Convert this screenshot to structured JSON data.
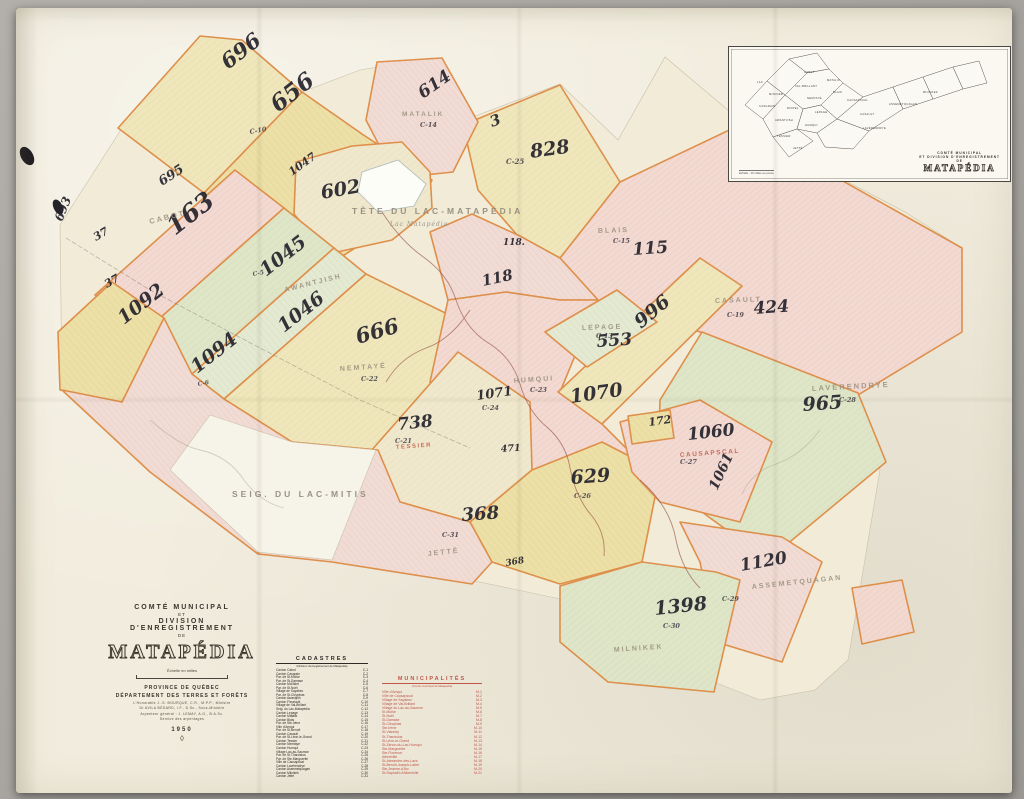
{
  "title_block": {
    "line1": "COMTÉ MUNICIPAL",
    "line2": "ET",
    "line3": "DIVISION D'ENREGISTREMENT",
    "line4": "DE",
    "name": "MATAPÉDIA",
    "scale_caption": "Échelle en milles",
    "province": "PROVINCE DE QUÉBEC",
    "department": "DÉPARTEMENT DES TERRES ET FORÊTS",
    "minister": "L'Honorable J.-S. BOURQUE, C.R., M.P.P., Ministre",
    "deputy": "Dr AVILA BÉDARD, I.F., D.Sc., Sous-Ministre",
    "surveyor": "Arpenteur général : J. LEMAY, A.G., B.A.Sc.",
    "service": "Service des arpentages",
    "year": "1950",
    "ornament": "◊"
  },
  "cadastres": {
    "title": "CADASTRES",
    "subtitle": "(Division d'enregistrement de Matapédia)",
    "rows": [
      {
        "n": "Canton Cabot",
        "c": "C-1"
      },
      {
        "n": "Canton Casgrain",
        "c": "C-2"
      },
      {
        "n": "Par. de St-Moïse",
        "c": "C-3"
      },
      {
        "n": "Par. de St-Damase",
        "c": "C-4"
      },
      {
        "n": "Canton McNider",
        "c": "C-5"
      },
      {
        "n": "Par. de St-Noël",
        "c": "C-6"
      },
      {
        "n": "Village de Sayabec",
        "c": "C-7"
      },
      {
        "n": "Par. de St-Cléophas",
        "c": "C-8"
      },
      {
        "n": "Canton Awantjish",
        "c": "C-9"
      },
      {
        "n": "Canton Fleuriault",
        "c": "C-10"
      },
      {
        "n": "Village de Val-Brillant",
        "c": "C-11"
      },
      {
        "n": "Seig. du Lac-Matapédia",
        "c": "C-12"
      },
      {
        "n": "Canton Lepage",
        "c": "C-13"
      },
      {
        "n": "Canton Matalik",
        "c": "C-14"
      },
      {
        "n": "Canton Blais",
        "c": "C-15"
      },
      {
        "n": "Par. de Ste-Irène",
        "c": "C-16"
      },
      {
        "n": "Ville d'Amqui",
        "c": "C-17"
      },
      {
        "n": "Par. de St-Benoît",
        "c": "C-18"
      },
      {
        "n": "Canton Casault",
        "c": "C-19"
      },
      {
        "n": "Par. de St-Léon-le-Grand",
        "c": "C-20"
      },
      {
        "n": "Canton Tessier",
        "c": "C-21"
      },
      {
        "n": "Canton Nemtayé",
        "c": "C-22"
      },
      {
        "n": "Canton Humqui",
        "c": "C-23"
      },
      {
        "n": "Village Lac-au-Saumon",
        "c": "C-24"
      },
      {
        "n": "Par. de St-Tharcisius",
        "c": "C-25"
      },
      {
        "n": "Par. de Ste-Marguerite",
        "c": "C-26"
      },
      {
        "n": "Ville de Causapscal",
        "c": "C-27"
      },
      {
        "n": "Canton Lavérendrye",
        "c": "C-28"
      },
      {
        "n": "Canton Assemetquagan",
        "c": "C-29"
      },
      {
        "n": "Canton Milnikek",
        "c": "C-30"
      },
      {
        "n": "Canton Jetté",
        "c": "C-31"
      }
    ]
  },
  "municipalites": {
    "title": "MUNICIPALITÉS",
    "subtitle": "(Comté municipal de Matapédia)",
    "rows": [
      {
        "n": "Ville d'Amqui",
        "c": "M-1"
      },
      {
        "n": "Ville de Causapscal",
        "c": "M-2"
      },
      {
        "n": "Village de Sayabec",
        "c": "M-3"
      },
      {
        "n": "Village de Val-Brillant",
        "c": "M-4"
      },
      {
        "n": "Village du Lac-au-Saumon",
        "c": "M-5"
      },
      {
        "n": "St-Moïse",
        "c": "M-6"
      },
      {
        "n": "St-Noël",
        "c": "M-7"
      },
      {
        "n": "St-Damase",
        "c": "M-8"
      },
      {
        "n": "St-Cléophas",
        "c": "M-9"
      },
      {
        "n": "Ste-Irène",
        "c": "M-10"
      },
      {
        "n": "St-Vianney",
        "c": "M-11"
      },
      {
        "n": "St-Tharcisius",
        "c": "M-12"
      },
      {
        "n": "St-Léon-le-Grand",
        "c": "M-13"
      },
      {
        "n": "St-Zénon-du-Lac-Humqui",
        "c": "M-14"
      },
      {
        "n": "Ste-Marguerite",
        "c": "M-15"
      },
      {
        "n": "Ste-Florence",
        "c": "M-16"
      },
      {
        "n": "Albertville",
        "c": "M-17"
      },
      {
        "n": "St-Alexandre-des-Lacs",
        "c": "M-18"
      },
      {
        "n": "St-Benoît-Joseph-Labre",
        "c": "M-19"
      },
      {
        "n": "Ste-Jeanne-d'Arc",
        "c": "M-20"
      },
      {
        "n": "St-Raphaël-d'Albertville",
        "c": "M-21"
      }
    ]
  },
  "inset": {
    "caption1": "COMTÉ MUNICIPAL",
    "caption2": "ET DIVISION D'ENREGISTREMENT",
    "caption3": "DE",
    "caption_name": "MATAPÉDIA",
    "scale_note": "Échelle : 10 milles au pouce",
    "labels": [
      {
        "t": "LAC",
        "x": 740,
        "y": 74
      },
      {
        "t": "McNIDER",
        "x": 752,
        "y": 86
      },
      {
        "t": "CABOT",
        "x": 787,
        "y": 64
      },
      {
        "t": "MATALIK",
        "x": 810,
        "y": 72
      },
      {
        "t": "BLAIS",
        "x": 816,
        "y": 84
      },
      {
        "t": "CASGRAIN",
        "x": 742,
        "y": 98
      },
      {
        "t": "RIOPEL",
        "x": 770,
        "y": 100
      },
      {
        "t": "NEMTAYÉ",
        "x": 790,
        "y": 90
      },
      {
        "t": "VAL-BRILLANT",
        "x": 778,
        "y": 78
      },
      {
        "t": "LEPAGE",
        "x": 798,
        "y": 104
      },
      {
        "t": "AWANTJISH",
        "x": 758,
        "y": 112
      },
      {
        "t": "HUMQUI",
        "x": 788,
        "y": 117
      },
      {
        "t": "TESSIER",
        "x": 760,
        "y": 128
      },
      {
        "t": "JETTÉ",
        "x": 776,
        "y": 140
      },
      {
        "t": "CASAULT",
        "x": 843,
        "y": 106
      },
      {
        "t": "LAVÉRENDRYE",
        "x": 846,
        "y": 120
      },
      {
        "t": "ASSEMETQUAGAN",
        "x": 872,
        "y": 96
      },
      {
        "t": "MILNIKEK",
        "x": 906,
        "y": 84
      },
      {
        "t": "CAUSAPSCAL",
        "x": 830,
        "y": 92
      }
    ]
  },
  "map": {
    "labels": [
      {
        "t": "696",
        "x": 228,
        "y": 70,
        "r": -38,
        "s": 21,
        "c": "num"
      },
      {
        "t": "656",
        "x": 278,
        "y": 113,
        "r": -38,
        "s": 23,
        "c": "num"
      },
      {
        "t": "695",
        "x": 162,
        "y": 186,
        "r": -33,
        "s": 13,
        "c": "num"
      },
      {
        "t": "693",
        "x": 62,
        "y": 222,
        "r": -68,
        "s": 12,
        "c": "num"
      },
      {
        "t": "37",
        "x": 96,
        "y": 241,
        "r": -30,
        "s": 11,
        "c": "num"
      },
      {
        "t": "37",
        "x": 107,
        "y": 288,
        "r": -30,
        "s": 11,
        "c": "num"
      },
      {
        "t": "1047",
        "x": 292,
        "y": 176,
        "r": -36,
        "s": 11,
        "c": "num"
      },
      {
        "t": "602",
        "x": 322,
        "y": 199,
        "r": -10,
        "s": 19,
        "c": "num"
      },
      {
        "t": "614",
        "x": 423,
        "y": 99,
        "r": -35,
        "s": 17,
        "c": "num"
      },
      {
        "t": "3",
        "x": 492,
        "y": 127,
        "r": -20,
        "s": 15,
        "c": "num"
      },
      {
        "t": "828",
        "x": 531,
        "y": 158,
        "r": -8,
        "s": 19,
        "c": "num"
      },
      {
        "t": "163",
        "x": 175,
        "y": 236,
        "r": -38,
        "s": 25,
        "c": "num"
      },
      {
        "t": "1045",
        "x": 266,
        "y": 277,
        "r": -38,
        "s": 19,
        "c": "num"
      },
      {
        "t": "1046",
        "x": 284,
        "y": 333,
        "r": -38,
        "s": 19,
        "c": "num"
      },
      {
        "t": "1092",
        "x": 124,
        "y": 325,
        "r": -38,
        "s": 19,
        "c": "num"
      },
      {
        "t": "1094",
        "x": 197,
        "y": 374,
        "r": -38,
        "s": 19,
        "c": "num"
      },
      {
        "t": "666",
        "x": 358,
        "y": 344,
        "r": -16,
        "s": 21,
        "c": "num"
      },
      {
        "t": "118.",
        "x": 503,
        "y": 245,
        "r": 0,
        "s": 9,
        "c": "num"
      },
      {
        "t": "118",
        "x": 483,
        "y": 286,
        "r": -12,
        "s": 15,
        "c": "num"
      },
      {
        "t": "115",
        "x": 633,
        "y": 255,
        "r": -4,
        "s": 17,
        "c": "num"
      },
      {
        "t": "996",
        "x": 641,
        "y": 329,
        "r": -40,
        "s": 19,
        "c": "num"
      },
      {
        "t": "553",
        "x": 597,
        "y": 347,
        "r": -4,
        "s": 17,
        "c": "num"
      },
      {
        "t": "424",
        "x": 754,
        "y": 314,
        "r": -4,
        "s": 17,
        "c": "num"
      },
      {
        "t": "1070",
        "x": 571,
        "y": 403,
        "r": -8,
        "s": 19,
        "c": "num"
      },
      {
        "t": "1071",
        "x": 477,
        "y": 400,
        "r": -8,
        "s": 13,
        "c": "num"
      },
      {
        "t": "738",
        "x": 398,
        "y": 430,
        "r": -6,
        "s": 17,
        "c": "num"
      },
      {
        "t": "172",
        "x": 649,
        "y": 426,
        "r": -8,
        "s": 11,
        "c": "num"
      },
      {
        "t": "1060",
        "x": 688,
        "y": 440,
        "r": -6,
        "s": 17,
        "c": "num"
      },
      {
        "t": "1061",
        "x": 717,
        "y": 491,
        "r": -65,
        "s": 14,
        "c": "num"
      },
      {
        "t": "471",
        "x": 501,
        "y": 452,
        "r": -4,
        "s": 9.5,
        "c": "num"
      },
      {
        "t": "629",
        "x": 571,
        "y": 484,
        "r": -4,
        "s": 19,
        "c": "num"
      },
      {
        "t": "368",
        "x": 462,
        "y": 521,
        "r": -4,
        "s": 18,
        "c": "num"
      },
      {
        "t": "368",
        "x": 506,
        "y": 566,
        "r": -10,
        "s": 9,
        "c": "num"
      },
      {
        "t": "1398",
        "x": 655,
        "y": 615,
        "r": -6,
        "s": 19,
        "c": "num"
      },
      {
        "t": "1120",
        "x": 741,
        "y": 571,
        "r": -10,
        "s": 17,
        "c": "num"
      },
      {
        "t": "965",
        "x": 803,
        "y": 411,
        "r": -4,
        "s": 19,
        "c": "num"
      },
      {
        "t": "C-25",
        "x": 506,
        "y": 164,
        "r": 0,
        "s": 7,
        "c": "code"
      },
      {
        "t": "C-10",
        "x": 250,
        "y": 134,
        "r": -10,
        "s": 6.5,
        "c": "code"
      },
      {
        "t": "C-14",
        "x": 420,
        "y": 127,
        "r": 0,
        "s": 6.5,
        "c": "code"
      },
      {
        "t": "C-15",
        "x": 613,
        "y": 243,
        "r": 0,
        "s": 6.5,
        "c": "code"
      },
      {
        "t": "C-13",
        "x": 596,
        "y": 338,
        "r": 0,
        "s": 6.5,
        "c": "code"
      },
      {
        "t": "C-19",
        "x": 727,
        "y": 317,
        "r": 0,
        "s": 6.5,
        "c": "code"
      },
      {
        "t": "C-22",
        "x": 361,
        "y": 381,
        "r": 0,
        "s": 6.5,
        "c": "code"
      },
      {
        "t": "C-23",
        "x": 530,
        "y": 392,
        "r": 0,
        "s": 6.5,
        "c": "code"
      },
      {
        "t": "C-24",
        "x": 482,
        "y": 410,
        "r": 0,
        "s": 6.5,
        "c": "code"
      },
      {
        "t": "C-21",
        "x": 395,
        "y": 443,
        "r": 0,
        "s": 6.5,
        "c": "code"
      },
      {
        "t": "C-26",
        "x": 574,
        "y": 498,
        "r": 0,
        "s": 6.5,
        "c": "code"
      },
      {
        "t": "C-27",
        "x": 680,
        "y": 464,
        "r": 0,
        "s": 6.5,
        "c": "code"
      },
      {
        "t": "C-28",
        "x": 839,
        "y": 402,
        "r": 0,
        "s": 6.5,
        "c": "code"
      },
      {
        "t": "C-29",
        "x": 722,
        "y": 601,
        "r": 0,
        "s": 6.5,
        "c": "code"
      },
      {
        "t": "C-30",
        "x": 663,
        "y": 628,
        "r": 0,
        "s": 6.5,
        "c": "code"
      },
      {
        "t": "C-31",
        "x": 442,
        "y": 537,
        "r": 0,
        "s": 6.5,
        "c": "code"
      },
      {
        "t": "C-5",
        "x": 253,
        "y": 276,
        "r": -10,
        "s": 6,
        "c": "code"
      },
      {
        "t": "C-6",
        "x": 198,
        "y": 386,
        "r": -10,
        "s": 6,
        "c": "code"
      },
      {
        "t": "CABOT",
        "x": 150,
        "y": 224,
        "r": -14,
        "s": 7.5,
        "c": "tn"
      },
      {
        "t": "MATALIK",
        "x": 402,
        "y": 116,
        "r": 0,
        "s": 6.5,
        "c": "tn"
      },
      {
        "t": "AWANTJISH",
        "x": 285,
        "y": 292,
        "r": -14,
        "s": 7,
        "c": "tn"
      },
      {
        "t": "NEMTAYÉ",
        "x": 340,
        "y": 371,
        "r": -4,
        "s": 7,
        "c": "tn"
      },
      {
        "t": "LEPAGE",
        "x": 582,
        "y": 330,
        "r": -2,
        "s": 7,
        "c": "tn"
      },
      {
        "t": "BLAIS",
        "x": 598,
        "y": 233,
        "r": -2,
        "s": 7,
        "c": "tn"
      },
      {
        "t": "CASAULT",
        "x": 715,
        "y": 303,
        "r": -2,
        "s": 7,
        "c": "tn"
      },
      {
        "t": "HUMQUI",
        "x": 514,
        "y": 383,
        "r": -4,
        "s": 7,
        "c": "tn"
      },
      {
        "t": "CAUSAPSCAL",
        "x": 680,
        "y": 457,
        "r": -4,
        "s": 6.5,
        "c": "tn-red"
      },
      {
        "t": "LAVÉRENDRYE",
        "x": 812,
        "y": 391,
        "r": -3,
        "s": 7.5,
        "c": "tn"
      },
      {
        "t": "ASSEMETQUAGAN",
        "x": 752,
        "y": 589,
        "r": -6,
        "s": 7,
        "c": "tn"
      },
      {
        "t": "MILNIKEK",
        "x": 614,
        "y": 652,
        "r": -4,
        "s": 7,
        "c": "tn"
      },
      {
        "t": "JETTÉ",
        "x": 428,
        "y": 556,
        "r": -6,
        "s": 7,
        "c": "tn"
      },
      {
        "t": "TESSIER",
        "x": 396,
        "y": 449,
        "r": -4,
        "s": 6,
        "c": "tn-red"
      },
      {
        "t": "TÊTE DU LAC-MATAPÉDIA",
        "x": 352,
        "y": 214,
        "r": 0,
        "s": 8.5,
        "c": "geo"
      },
      {
        "t": "Lac Matapédia",
        "x": 390,
        "y": 226,
        "r": 0,
        "s": 6,
        "c": "geo-it"
      },
      {
        "t": "SEIG. DU LAC-MITIS",
        "x": 232,
        "y": 497,
        "r": 0,
        "s": 8.5,
        "c": "geo"
      }
    ]
  }
}
